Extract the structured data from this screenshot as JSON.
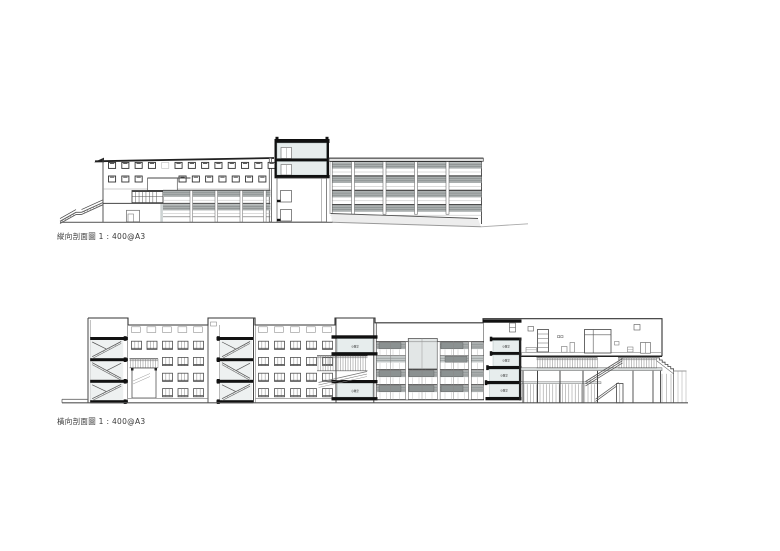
{
  "page": {
    "background": "#ffffff"
  },
  "colors": {
    "line": "#444444",
    "slab": "#111111",
    "room_fill": "#e7eded",
    "louver": "#aaafaf",
    "louver_light": "#c4c9c9",
    "dark_cell": "#8b9191",
    "panel": "#e2e6e6",
    "deck": "#d8dcdc",
    "terrain": "#ededed"
  },
  "drawings": {
    "top": {
      "caption": "縱向剖面圖 1 : 400@A3"
    },
    "bottom": {
      "caption": "橫向剖面圖 1 : 400@A3"
    },
    "room_label": "小教室"
  }
}
